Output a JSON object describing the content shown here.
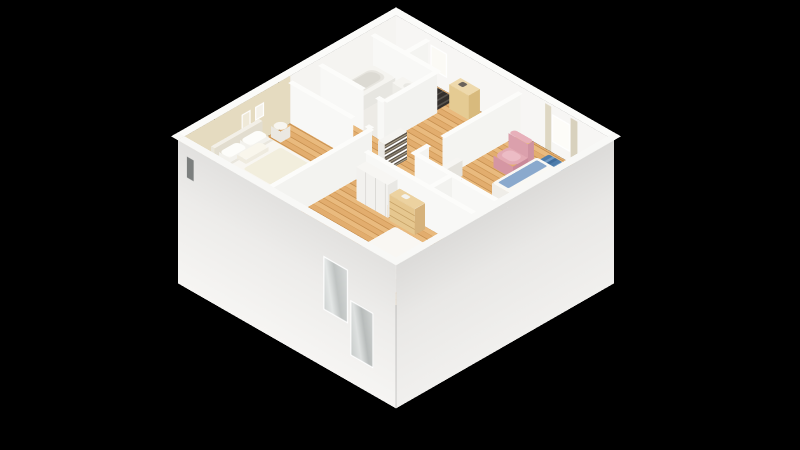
{
  "meta": {
    "view": "3d-isometric-floorplan-render",
    "background": "#000000"
  },
  "palette": {
    "wall_face": "#f6f5f3",
    "wall_top": "#fcfcfa",
    "exterior_wall": "#f0efed",
    "accent_wall_beige": "#e5dbc0",
    "wood_floor": "#e0aa6c",
    "bath_floor": "#edebe6",
    "rug_blue": "#4d7cab",
    "armchair_pink": "#e3aab4",
    "pillow_blue": "#8fb0d6",
    "furniture_tan": "#e8cf9e",
    "glass": "#c9cdcc",
    "stairs_dark": "#3a3734"
  },
  "camera": {
    "rotateX": 55,
    "rotateZ": 45,
    "scale": 1.06,
    "centerX": 396,
    "centerY": 184,
    "planSize": 300
  },
  "scene": {
    "floors": [
      {
        "name": "floor-wood-main",
        "x": 9,
        "y": 9,
        "w": 282,
        "d": 282,
        "z": 0,
        "bg": "repeating-linear-gradient(0deg,#e2ad6e 0px 6px,#d19a58 6px 7px,#e9ba7e 7px 13px,#c68f4f 13px 14px)"
      },
      {
        "name": "floor-bathroom-tile",
        "x": 9,
        "y": 40,
        "w": 86,
        "d": 70,
        "z": 0.4,
        "bg": "#edebe6"
      },
      {
        "name": "floor-stairs",
        "x": 52,
        "y": 11,
        "w": 40,
        "d": 27,
        "z": 0.5,
        "bg": "repeating-linear-gradient(90deg,#56524d 0px 2px,#332f2c 2px 7px)"
      },
      {
        "name": "bedroom1-rug",
        "x": 14,
        "y": 190,
        "w": 84,
        "d": 88,
        "z": 0.5,
        "bg": "#efe9db",
        "r": 4
      },
      {
        "name": "bedroom2-rug",
        "x": 218,
        "y": 14,
        "w": 64,
        "d": 40,
        "z": 0.4,
        "r": 2,
        "bg": "repeating-linear-gradient(90deg,#4d7cab 0px 5px,#7099c2 5px 8px,#3f6d9d 8px 12px)"
      }
    ],
    "walls": [
      {
        "name": "wall-ext-nw",
        "dir": "y",
        "x": 9,
        "y": 9,
        "len": 291,
        "z": 0,
        "h": 55,
        "bg": "#f5f4f1",
        "children": [
          {
            "name": "accent-wall-beige",
            "off": 141,
            "w": 150,
            "zb": 0,
            "h": 55,
            "bg": "#e5dbc0"
          },
          {
            "name": "picture-frame-a",
            "off": 176,
            "w": 12,
            "zb": 26,
            "h": 16,
            "bg": "#f5f2ea",
            "frame": true,
            "layer": 1
          },
          {
            "name": "picture-frame-b",
            "off": 194,
            "w": 12,
            "zb": 24,
            "h": 18,
            "bg": "#efe9d8",
            "frame": true,
            "layer": 1
          }
        ]
      },
      {
        "name": "wall-ext-ne",
        "dir": "x",
        "x": 9,
        "y": 9,
        "len": 291,
        "z": 0,
        "h": 55,
        "bg": "#f7f6f4",
        "children": [
          {
            "name": "stairwell-window",
            "off": 46,
            "w": 22,
            "zb": 16,
            "h": 28,
            "bg": "#fbfaf5",
            "frame": true
          },
          {
            "name": "bedroom2-window",
            "off": 208,
            "w": 24,
            "zb": 12,
            "h": 32,
            "bg": "#fdfcf8",
            "frame": true
          },
          {
            "name": "curtain-left",
            "off": 199,
            "w": 8,
            "zb": 0,
            "h": 52,
            "bg": "#ded7c3",
            "layer": 1
          },
          {
            "name": "curtain-right",
            "off": 233,
            "w": 9,
            "zb": 0,
            "h": 52,
            "bg": "#d8d1bd",
            "layer": 1
          }
        ]
      },
      {
        "name": "wall-ext-se",
        "dir": "y",
        "x": 300,
        "y": 9,
        "len": 291,
        "z": -110,
        "h": 165,
        "bg": "linear-gradient(#f1f0ee 0%,#e9e8e6 60%,#dcdbd9 100%)"
      },
      {
        "name": "wall-ext-sw",
        "dir": "x",
        "x": 9,
        "y": 300,
        "len": 291,
        "z": -110,
        "h": 165,
        "bg": "linear-gradient(#f6f5f3 0%,#edecea 60%,#e2e1df 100%)",
        "children": [
          {
            "name": "small-slit-window",
            "off": 12,
            "w": 9,
            "zb": 18,
            "h": 24,
            "bg": "#7c7f7e"
          },
          {
            "name": "balcony-glass-door-left",
            "off": 194,
            "w": 33,
            "zb": -44,
            "h": 62,
            "frame": true,
            "bg": "linear-gradient(100deg,#cdd1d0 0%,#e4e7e6 30%,#bfc3c2 55%,#d9dcdb 100%)"
          },
          {
            "name": "balcony-glass-door-right",
            "off": 230,
            "w": 31,
            "zb": -79,
            "h": 64,
            "frame": true,
            "bg": "linear-gradient(100deg,#c6cac9 0%,#dfe2e1 35%,#b8bcbb 60%,#d3d6d5 100%)"
          }
        ]
      },
      {
        "name": "wall-bath-north",
        "dir": "x",
        "x": 9,
        "y": 40,
        "len": 86,
        "z": 0,
        "h": 48,
        "bg": "#f8f8f6"
      },
      {
        "name": "wall-bath-east",
        "dir": "y",
        "x": 95,
        "y": 40,
        "len": 70,
        "z": 0,
        "h": 48,
        "bg": "#f2f2ef"
      },
      {
        "name": "wall-bath-south-a",
        "dir": "x",
        "x": 9,
        "y": 110,
        "len": 58,
        "z": 0,
        "h": 48,
        "bg": "#f8f8f6"
      },
      {
        "name": "wall-bath-south-b",
        "dir": "x",
        "x": 85,
        "y": 110,
        "len": 10,
        "z": 0,
        "h": 48,
        "bg": "#f8f8f6"
      },
      {
        "name": "wall-stair-stub",
        "dir": "y",
        "x": 52,
        "y": 9,
        "len": 31,
        "z": 0,
        "h": 48,
        "bg": "#f4f4f1"
      },
      {
        "name": "wall-bedroom1-north-a",
        "dir": "x",
        "x": 9,
        "y": 150,
        "len": 84,
        "z": 0,
        "h": 48,
        "bg": "#f8f8f6"
      },
      {
        "name": "wall-bedroom1-north-b",
        "dir": "x",
        "x": 111,
        "y": 150,
        "len": 7,
        "z": 0,
        "h": 48,
        "bg": "#f8f8f6"
      },
      {
        "name": "wall-bedroom1-east",
        "dir": "y",
        "x": 118,
        "y": 150,
        "len": 141,
        "z": 0,
        "h": 48,
        "bg": "#f3f3f0"
      },
      {
        "name": "wall-bedroom2-west-a",
        "dir": "y",
        "x": 175,
        "y": 9,
        "len": 104,
        "z": 0,
        "h": 48,
        "bg": "#f4f4f1"
      },
      {
        "name": "wall-bedroom2-west-b",
        "dir": "y",
        "x": 175,
        "y": 131,
        "len": 19,
        "z": 0,
        "h": 48,
        "bg": "#f4f4f1"
      },
      {
        "name": "wall-bedroom2-south",
        "dir": "x",
        "x": 175,
        "y": 150,
        "len": 125,
        "z": 0,
        "h": 48,
        "bg": "#f8f8f6"
      },
      {
        "name": "wall-bedroom3-north",
        "dir": "x",
        "x": 140,
        "y": 180,
        "len": 160,
        "z": 0,
        "h": 48,
        "bg": "#f8f8f6"
      },
      {
        "name": "wall-wc-west",
        "dir": "y",
        "x": 225,
        "y": 150,
        "len": 30,
        "z": 0,
        "h": 48,
        "bg": "#f2f2ef"
      }
    ],
    "tops": [
      {
        "name": "walltop-nw",
        "x": 0,
        "y": 0,
        "w": 9,
        "d": 300,
        "z": 55,
        "bg": "#fbfbf9"
      },
      {
        "name": "walltop-ne",
        "x": 0,
        "y": 0,
        "w": 300,
        "d": 9,
        "z": 55,
        "bg": "#fbfbf9"
      },
      {
        "name": "walltop-se",
        "x": 291,
        "y": 0,
        "w": 9,
        "d": 300,
        "z": 55,
        "bg": "#f8f8f6"
      },
      {
        "name": "walltop-sw",
        "x": 0,
        "y": 291,
        "w": 300,
        "d": 9,
        "z": 55,
        "bg": "#f8f8f6"
      },
      {
        "name": "walltop-bath-north",
        "x": 9,
        "y": 37,
        "w": 86,
        "d": 6,
        "z": 48,
        "bg": "#fcfcfa"
      },
      {
        "name": "walltop-bath-east",
        "x": 92,
        "y": 37,
        "w": 6,
        "d": 73,
        "z": 48,
        "bg": "#fcfcfa"
      },
      {
        "name": "walltop-bath-south-a",
        "x": 9,
        "y": 107,
        "w": 58,
        "d": 6,
        "z": 48,
        "bg": "#fcfcfa"
      },
      {
        "name": "walltop-bath-south-b",
        "x": 85,
        "y": 107,
        "w": 10,
        "d": 6,
        "z": 48,
        "bg": "#fcfcfa"
      },
      {
        "name": "walltop-stair-stub",
        "x": 49,
        "y": 9,
        "w": 6,
        "d": 31,
        "z": 48,
        "bg": "#fcfcfa"
      },
      {
        "name": "walltop-bedroom1-north-a",
        "x": 9,
        "y": 147,
        "w": 84,
        "d": 6,
        "z": 48,
        "bg": "#fcfcfa"
      },
      {
        "name": "walltop-bedroom1-north-b",
        "x": 111,
        "y": 147,
        "w": 7,
        "d": 6,
        "z": 48,
        "bg": "#fcfcfa"
      },
      {
        "name": "walltop-bedroom1-east",
        "x": 115,
        "y": 150,
        "w": 6,
        "d": 141,
        "z": 48,
        "bg": "#fcfcfa"
      },
      {
        "name": "walltop-bedroom2-west-a",
        "x": 172,
        "y": 9,
        "w": 6,
        "d": 104,
        "z": 48,
        "bg": "#fcfcfa"
      },
      {
        "name": "walltop-bedroom2-west-b",
        "x": 172,
        "y": 131,
        "w": 6,
        "d": 19,
        "z": 48,
        "bg": "#fcfcfa"
      },
      {
        "name": "walltop-bedroom2-south",
        "x": 172,
        "y": 147,
        "w": 128,
        "d": 6,
        "z": 48,
        "bg": "#fcfcfa"
      },
      {
        "name": "walltop-bedroom3-north",
        "x": 140,
        "y": 177,
        "w": 160,
        "d": 6,
        "z": 48,
        "bg": "#fcfcfa"
      },
      {
        "name": "walltop-wc-west",
        "x": 222,
        "y": 150,
        "w": 6,
        "d": 33,
        "z": 48,
        "bg": "#fcfcfa"
      }
    ],
    "boxes": [
      {
        "name": "bedroom1-bed",
        "x": 12,
        "y": 196,
        "w": 80,
        "d": 58,
        "z": 0,
        "h": 15,
        "r": 3,
        "top": "#f8f6f1",
        "side": "#eeece5",
        "side2": "#e5e3da"
      },
      {
        "name": "bedroom1-headboard",
        "x": 9,
        "y": 192,
        "w": 5,
        "d": 64,
        "z": 0,
        "h": 26,
        "top": "#f3f0e8",
        "side": "#eae6da",
        "side2": "#e2ddcf"
      },
      {
        "name": "bedroom1-pillow-a",
        "x": 16,
        "y": 200,
        "w": 14,
        "d": 24,
        "z": 15,
        "h": 6,
        "r": 5,
        "top": "#fdfdfa",
        "side": "#f3f2ed"
      },
      {
        "name": "bedroom1-pillow-b",
        "x": 16,
        "y": 228,
        "w": 14,
        "d": 24,
        "z": 15,
        "h": 6,
        "r": 5,
        "top": "#fdfdfa",
        "side": "#f3f2ed"
      },
      {
        "name": "bedroom1-pillow-c",
        "x": 30,
        "y": 212,
        "w": 12,
        "d": 30,
        "z": 15,
        "h": 5,
        "r": 5,
        "top": "#f9f6ec",
        "side": "#efebdf"
      },
      {
        "name": "bedroom1-nightstand",
        "x": 12,
        "y": 166,
        "w": 13,
        "d": 13,
        "z": 0,
        "h": 13,
        "r": 7,
        "top": "#f7f5f0",
        "side": "#ebe8e1"
      },
      {
        "name": "bathtub",
        "x": 13,
        "y": 44,
        "w": 30,
        "d": 58,
        "z": 0,
        "h": 17,
        "r": 4,
        "top": "#f5f4f0",
        "side": "#efeeea",
        "side2": "#e7e6e1"
      },
      {
        "name": "bathroom-vanity",
        "x": 52,
        "y": 43,
        "w": 40,
        "d": 14,
        "z": 0,
        "h": 22,
        "top": "#f6f5f1",
        "side": "#edece7",
        "side2": "#e4e3dd"
      },
      {
        "name": "entry-cabinet",
        "x": 98,
        "y": 12,
        "w": 26,
        "d": 15,
        "z": 0,
        "h": 28,
        "top": "#eed9ac",
        "side": "#e5cb93",
        "side2": "#d8ba7d"
      },
      {
        "name": "stair-cupboard",
        "x": 148,
        "y": 54,
        "w": 22,
        "d": 15,
        "z": 0,
        "h": 20,
        "top": "#f6f5f2",
        "side": "#eceae5",
        "side2": "#e3e1db"
      },
      {
        "name": "hall-bookshelf",
        "x": 120,
        "y": 114,
        "w": 9,
        "d": 30,
        "z": 0,
        "h": 32,
        "top": "#f5f4f1",
        "side": "#eceae6",
        "side2": "repeating-linear-gradient(0deg,#5a5248 0px 2px,#b5a98f 2px 3px,#6e655a 3px 5px,#ffffff 5px 7px)"
      },
      {
        "name": "hall-radiator",
        "x": 246,
        "y": 153,
        "w": 44,
        "d": 5,
        "z": 5,
        "h": 14,
        "top": "#fafaf8",
        "side": "repeating-linear-gradient(90deg,#ffffff 0px 3px,#d8d7d4 3px 5px)",
        "side2": "#e8e7e4"
      },
      {
        "name": "bedroom3-closet",
        "x": 142,
        "y": 182,
        "w": 42,
        "d": 13,
        "z": 0,
        "h": 38,
        "top": "#f7f6f3",
        "side": "repeating-linear-gradient(90deg,#f2f1ee 0px 12px,#d9d8d4 12px 13px)",
        "side2": "#e9e8e4"
      },
      {
        "name": "bedroom3-dresser",
        "x": 188,
        "y": 183,
        "w": 34,
        "d": 14,
        "z": 0,
        "h": 30,
        "top": "#ecd2a0",
        "side": "repeating-linear-gradient(0deg,#e6c78f 0px 7px,#c8a368 7px 8px)",
        "side2": "#d6b27b"
      },
      {
        "name": "bedroom3-bed",
        "x": 214,
        "y": 215,
        "w": 62,
        "d": 74,
        "z": 0,
        "h": 15,
        "r": 3,
        "top": "#f9f7f3",
        "side": "#efede7",
        "side2": "#e6e4dc"
      },
      {
        "name": "bedroom3-headboard",
        "x": 210,
        "y": 287,
        "w": 70,
        "d": 5,
        "z": 0,
        "h": 24,
        "top": "#f4f2ec",
        "side": "#ebe8e0",
        "side2": "#e2dfd6"
      },
      {
        "name": "bedroom3-pillow-a",
        "x": 222,
        "y": 266,
        "w": 22,
        "d": 14,
        "z": 15,
        "h": 6,
        "r": 5,
        "top": "#fcfbf7",
        "side": "#f1efe9"
      },
      {
        "name": "bedroom3-pillow-b",
        "x": 248,
        "y": 266,
        "w": 22,
        "d": 14,
        "z": 15,
        "h": 6,
        "r": 5,
        "top": "#fcfbf7",
        "side": "#f1efe9"
      },
      {
        "name": "wc-toilet-tank",
        "x": 232,
        "y": 152,
        "w": 16,
        "d": 5,
        "z": 0,
        "h": 20,
        "top": "#f8f8f5",
        "side": "#efefeb",
        "side2": "#e6e6e1"
      },
      {
        "name": "wc-toilet-bowl",
        "x": 234,
        "y": 157,
        "w": 12,
        "d": 13,
        "z": 0,
        "h": 12,
        "r": 6,
        "top": "#fbfbf8",
        "side": "#f0f0ec"
      },
      {
        "name": "bedroom2-bed",
        "x": 228,
        "y": 40,
        "w": 63,
        "d": 60,
        "z": 0,
        "h": 15,
        "r": 3,
        "top": "#f9f8f4",
        "side": "#efede8",
        "side2": "#e5e3dc"
      },
      {
        "name": "bedroom2-headboard",
        "x": 287,
        "y": 38,
        "w": 4,
        "d": 64,
        "z": 0,
        "h": 24,
        "top": "#f4f2ec",
        "side": "#ebe8e0",
        "side2": "#e2dfd6"
      },
      {
        "name": "bedroom2-pillow-a",
        "x": 274,
        "y": 44,
        "w": 14,
        "d": 24,
        "z": 15,
        "h": 6,
        "r": 4,
        "top": "#8fb0d6",
        "side": "#7b9cc4"
      },
      {
        "name": "bedroom2-pillow-b",
        "x": 274,
        "y": 72,
        "w": 14,
        "d": 24,
        "z": 15,
        "h": 6,
        "r": 4,
        "top": "#8fb0d6",
        "side": "#7b9cc4"
      },
      {
        "name": "bedroom2-console",
        "x": 178,
        "y": 96,
        "w": 7,
        "d": 26,
        "z": 0,
        "h": 18,
        "top": "#f6f5f2",
        "side": "#edebe6",
        "side2": "#e4e2dc"
      },
      {
        "name": "armchair-seat",
        "x": 196,
        "y": 42,
        "w": 26,
        "d": 24,
        "z": 0,
        "h": 14,
        "r": 8,
        "top": "#e3aab4",
        "side": "#d596a3",
        "side2": "#c9899a"
      },
      {
        "name": "armchair-back",
        "x": 196,
        "y": 38,
        "w": 26,
        "d": 8,
        "z": 0,
        "h": 30,
        "r": 6,
        "top": "#e7b0ba",
        "side": "#dba0ac",
        "side2": "#cf93a1"
      }
    ],
    "flats": [
      {
        "name": "bathtub-basin-inner",
        "x": 17,
        "y": 49,
        "w": 21,
        "d": 48,
        "z": 17.5,
        "bg": "#e7e5df",
        "r": 8
      },
      {
        "name": "bathtub-basin-deep",
        "x": 19,
        "y": 52,
        "w": 17,
        "d": 42,
        "z": 17.7,
        "bg": "#dcdad3",
        "r": 8
      },
      {
        "name": "vanity-basin",
        "x": 62,
        "y": 46,
        "w": 18,
        "d": 9,
        "z": 22.4,
        "bg": "#e9e8e3",
        "r": 6
      },
      {
        "name": "entry-cabinet-deco",
        "x": 104,
        "y": 15,
        "w": 7,
        "d": 7,
        "z": 28.5,
        "bg": "#6a625a",
        "r": 2
      },
      {
        "name": "dresser-tray",
        "x": 198,
        "y": 186,
        "w": 8,
        "d": 6,
        "z": 30.5,
        "bg": "#f4f3ef",
        "r": 2
      },
      {
        "name": "bedroom1-duvet-fold",
        "x": 30,
        "y": 197,
        "w": 3,
        "d": 56,
        "z": 15.6,
        "bg": "#e9e6dd"
      },
      {
        "name": "bedroom1-blanket",
        "x": 46,
        "y": 200,
        "w": 40,
        "d": 50,
        "z": 15.5,
        "bg": "#f2eedd",
        "r": 3
      },
      {
        "name": "bedroom3-duvet-fold",
        "x": 216,
        "y": 252,
        "w": 58,
        "d": 4,
        "z": 15.6,
        "bg": "#e8e5dc"
      },
      {
        "name": "bedroom2-duvet-fold",
        "x": 252,
        "y": 42,
        "w": 4,
        "d": 56,
        "z": 15.6,
        "bg": "#eae8e1"
      },
      {
        "name": "bedroom2-throw-blanket",
        "x": 232,
        "y": 44,
        "w": 14,
        "d": 52,
        "z": 15.7,
        "bg": "#8aa9cd",
        "r": 2
      },
      {
        "name": "armchair-cushion",
        "x": 200,
        "y": 48,
        "w": 18,
        "d": 14,
        "z": 14.5,
        "bg": "#ecbcc5",
        "r": 6
      },
      {
        "name": "wc-bath-mat",
        "x": 233,
        "y": 171,
        "w": 15,
        "d": 8,
        "z": 0.6,
        "bg": "#eab9c1",
        "r": 3
      }
    ]
  }
}
